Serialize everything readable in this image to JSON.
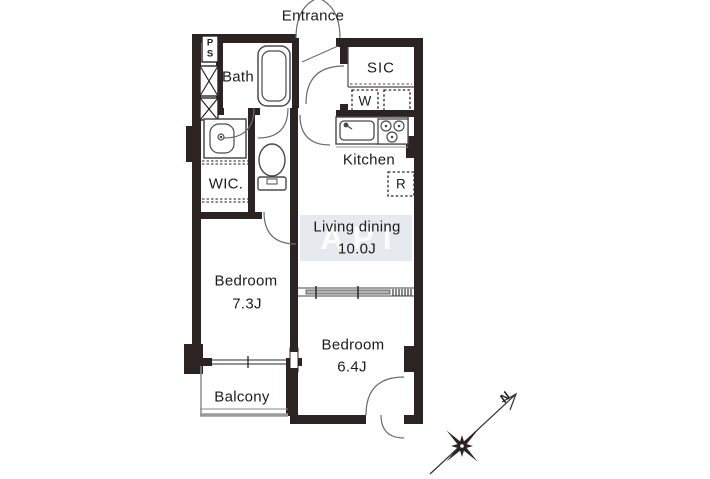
{
  "colors": {
    "wall": "#2b2422",
    "fixture_line": "#4a4a4a",
    "thin_line": "#6a6a6a",
    "watermark_bg": "#e6eaee",
    "watermark_text": "#fbfcfd",
    "text": "#1c1c1c",
    "background": "#ffffff"
  },
  "labels": {
    "entrance": "Entrance",
    "pipe_shaft": "PS",
    "bath": "Bath",
    "shoe_closet": "SIC",
    "washer": "W",
    "kitchen": "Kitchen",
    "refrigerator": "R",
    "walk_in_closet": "WIC.",
    "living_name": "Living dining",
    "living_size": "10.0J",
    "bedroom1_name": "Bedroom",
    "bedroom1_size": "7.3J",
    "bedroom2_name": "Bedroom",
    "bedroom2_size": "6.4J",
    "balcony": "Balcony",
    "compass_north": "N",
    "watermark": "API"
  }
}
